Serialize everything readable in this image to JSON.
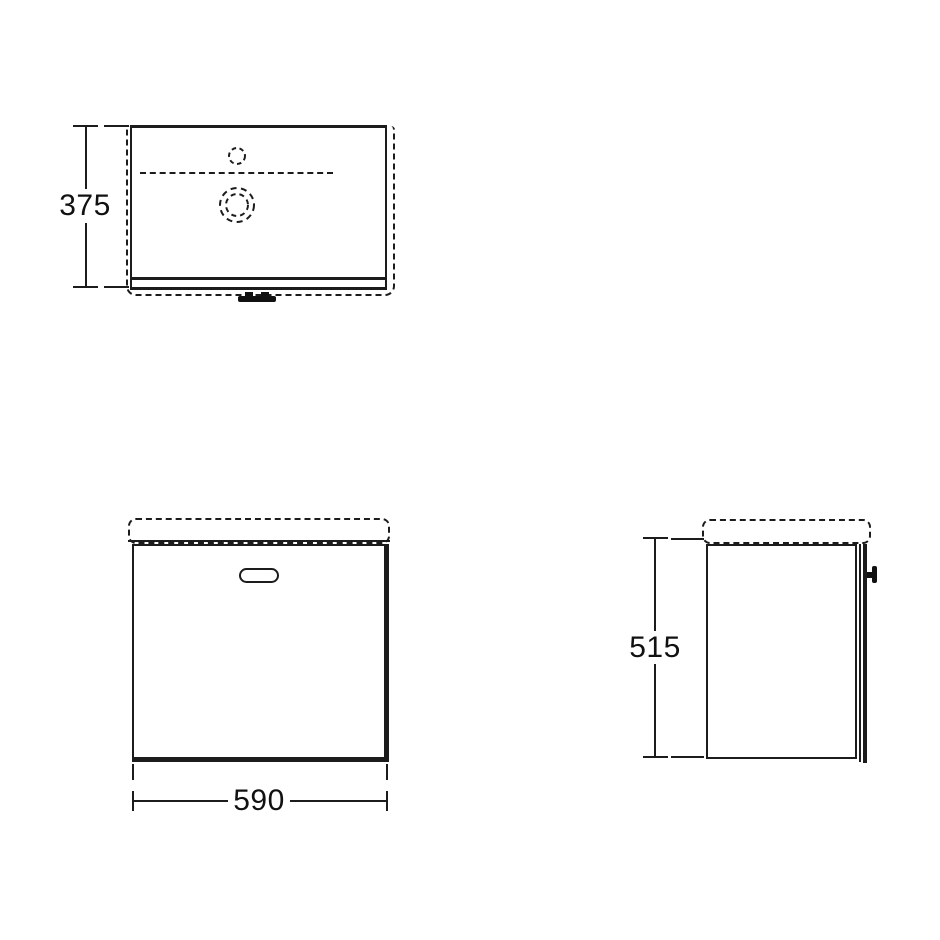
{
  "drawing": {
    "background": "#ffffff",
    "line_color": "#1c1c1c",
    "plan_view": {
      "depth_dimension": "375"
    },
    "front_view": {
      "width_dimension": "590"
    },
    "side_view": {
      "height_dimension": "515"
    }
  }
}
